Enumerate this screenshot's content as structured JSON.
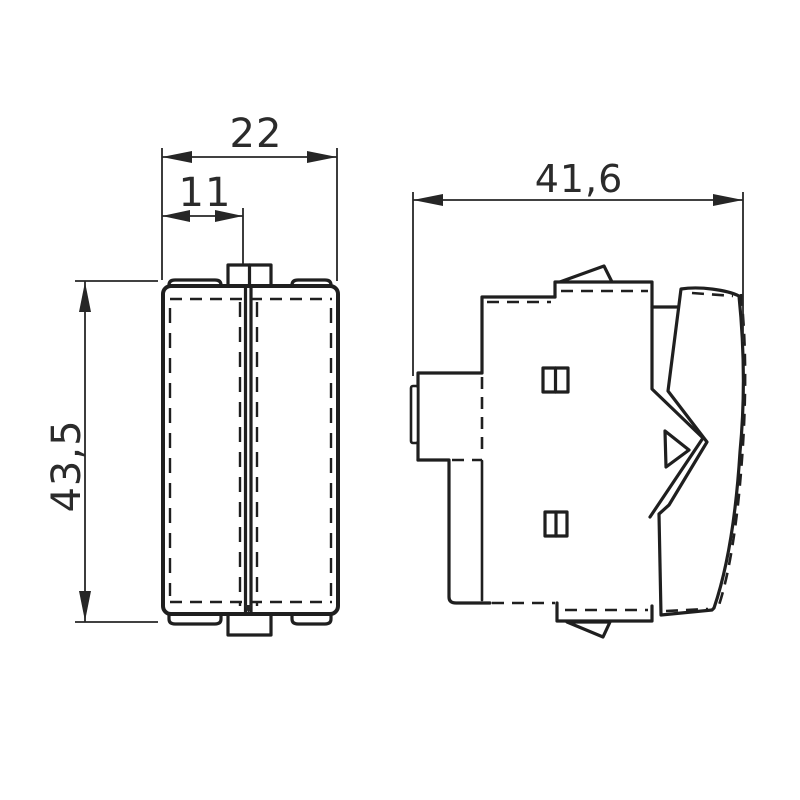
{
  "canvas": {
    "background": "#ffffff",
    "line_color": "#1f1f1f",
    "dimension_text_color": "#2b2b2b"
  },
  "dimensions": {
    "front_width": "22",
    "front_half_width": "11",
    "side_depth": "41,6",
    "overall_height": "43,5"
  }
}
